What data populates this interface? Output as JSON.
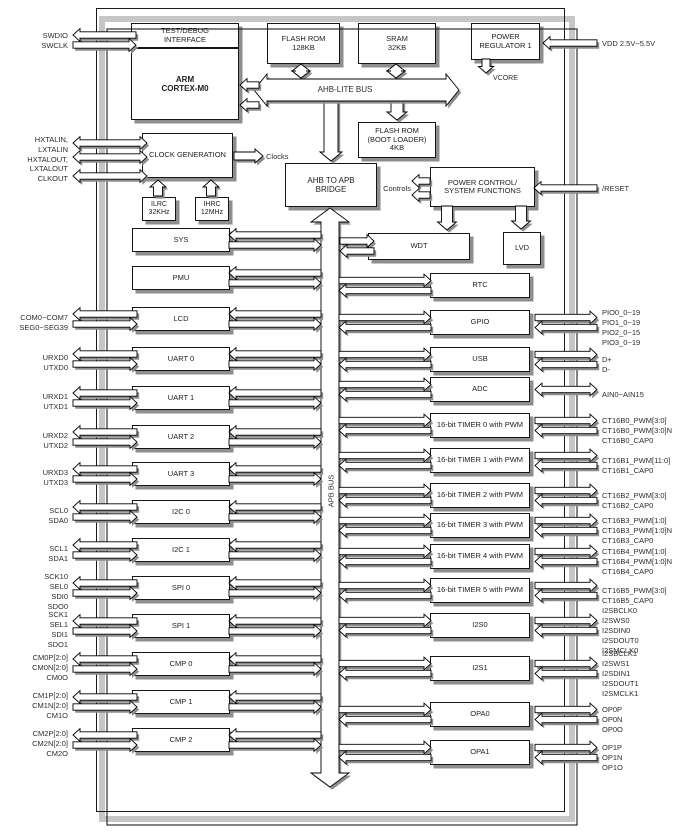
{
  "blocks": {
    "test_debug": "TEST/DEBUG\nINTERFACE",
    "arm": "ARM\nCORTEX-M0",
    "flash_main": "FLASH ROM\n128KB",
    "sram": "SRAM\n32KB",
    "power_regulator": "POWER\nREGULATOR 1",
    "vcore": "VCORE",
    "flash_boot": "FLASH ROM\n(BOOT LOADER)\n4KB",
    "clock_generation": "CLOCK GENERATION",
    "ilrc": "ILRC\n32KHz",
    "ihrc": "IHRC\n12MHz",
    "bridge": "AHB TO APB\nBRIDGE",
    "power_control": "POWER CONTROL/\nSYSTEM FUNCTIONS",
    "wdt": "WDT",
    "lvd": "LVD"
  },
  "bus_labels": {
    "ahb": "AHB-LITE BUS",
    "apb": "APB BUS",
    "clocks": "Clocks",
    "controls": "Controls"
  },
  "cpu_pins": [
    "SWDIO",
    "SWCLK"
  ],
  "clock_pins": [
    "HXTALIN,",
    "LXTALIN",
    "HXTALOUT,",
    "LXTALOUT",
    "CLKOUT"
  ],
  "power_pins": {
    "vdd": "VDD 2.5V~5.5V",
    "reset": "/RESET"
  },
  "left_peripherals": [
    {
      "label": "SYS",
      "pins": []
    },
    {
      "label": "PMU",
      "pins": []
    },
    {
      "label": "LCD",
      "pins": [
        "COM0~COM7",
        "SEG0~SEG39"
      ]
    },
    {
      "label": "UART 0",
      "pins": [
        "URXD0",
        "UTXD0"
      ]
    },
    {
      "label": "UART 1",
      "pins": [
        "URXD1",
        "UTXD1"
      ]
    },
    {
      "label": "UART 2",
      "pins": [
        "URXD2",
        "UTXD2"
      ]
    },
    {
      "label": "UART 3",
      "pins": [
        "URXD3",
        "UTXD3"
      ]
    },
    {
      "label": "I2C 0",
      "pins": [
        "SCL0",
        "SDA0"
      ]
    },
    {
      "label": "I2C 1",
      "pins": [
        "SCL1",
        "SDA1"
      ]
    },
    {
      "label": "SPI 0",
      "pins": [
        "SCK10",
        "SEL0",
        "SDI0",
        "SDO0"
      ]
    },
    {
      "label": "SPI 1",
      "pins": [
        "SCK1",
        "SEL1",
        "SDI1",
        "SDO1"
      ]
    },
    {
      "label": "CMP 0",
      "pins": [
        "CM0P[2:0]",
        "CM0N[2:0]",
        "CM0O"
      ]
    },
    {
      "label": "CMP 1",
      "pins": [
        "CM1P[2:0]",
        "CM1N[2:0]",
        "CM1O"
      ]
    },
    {
      "label": "CMP 2",
      "pins": [
        "CM2P[2:0]",
        "CM2N[2:0]",
        "CM2O"
      ]
    }
  ],
  "right_peripherals": [
    {
      "label": "RTC",
      "pins": []
    },
    {
      "label": "GPIO",
      "pins": [
        "PIO0_0~19",
        "PIO1_0~19",
        "PIO2_0~15",
        "PIO3_0~19"
      ]
    },
    {
      "label": "USB",
      "pins": [
        "D+",
        "D-"
      ]
    },
    {
      "label": "ADC",
      "pins": [
        "AIN0~AIN15"
      ]
    },
    {
      "label": "16-bit TIMER 0 with PWM",
      "pins": [
        "CT16B0_PWM[3:0]",
        "CT16B0_PWM[3:0]N",
        "CT16B0_CAP0"
      ]
    },
    {
      "label": "16-bit TIMER 1 with PWM",
      "pins": [
        "CT16B1_PWM[11:0]",
        "CT16B1_CAP0"
      ]
    },
    {
      "label": "16-bit TIMER 2 with PWM",
      "pins": [
        "CT16B2_PWM[3:0]",
        "CT16B2_CAP0"
      ]
    },
    {
      "label": "16-bit TIMER 3 with PWM",
      "pins": [
        "CT16B3_PWM[1:0]",
        "CT16B3_PWM[1:0]N",
        "CT16B3_CAP0"
      ]
    },
    {
      "label": "16-bit TIMER 4 with PWM",
      "pins": [
        "CT16B4_PWM[1:0]",
        "CT16B4_PWM[1:0]N",
        "CT16B4_CAP0"
      ]
    },
    {
      "label": "16-bit TIMER 5 with PWM",
      "pins": [
        "CT16B5_PWM[3:0]",
        "CT16B5_CAP0"
      ]
    },
    {
      "label": "I2S0",
      "pins": [
        "I2SBCLK0",
        "I2SWS0",
        "I2SDIN0",
        "I2SDOUT0",
        "I2SMCLK0"
      ]
    },
    {
      "label": "I2S1",
      "pins": [
        "I2SBCLK1",
        "I2SWS1",
        "I2SDIN1",
        "I2SDOUT1",
        "I2SMCLK1"
      ]
    },
    {
      "label": "OPA0",
      "pins": [
        "OP0P",
        "OP0N",
        "OP0O"
      ]
    },
    {
      "label": "OPA1",
      "pins": [
        "OP1P",
        "OP1N",
        "OP1O"
      ]
    }
  ],
  "colors": {
    "box_fill": "#ffffff",
    "box_border": "#161616",
    "shadow": "#8e8e8e",
    "text": "#2c2c2c"
  }
}
